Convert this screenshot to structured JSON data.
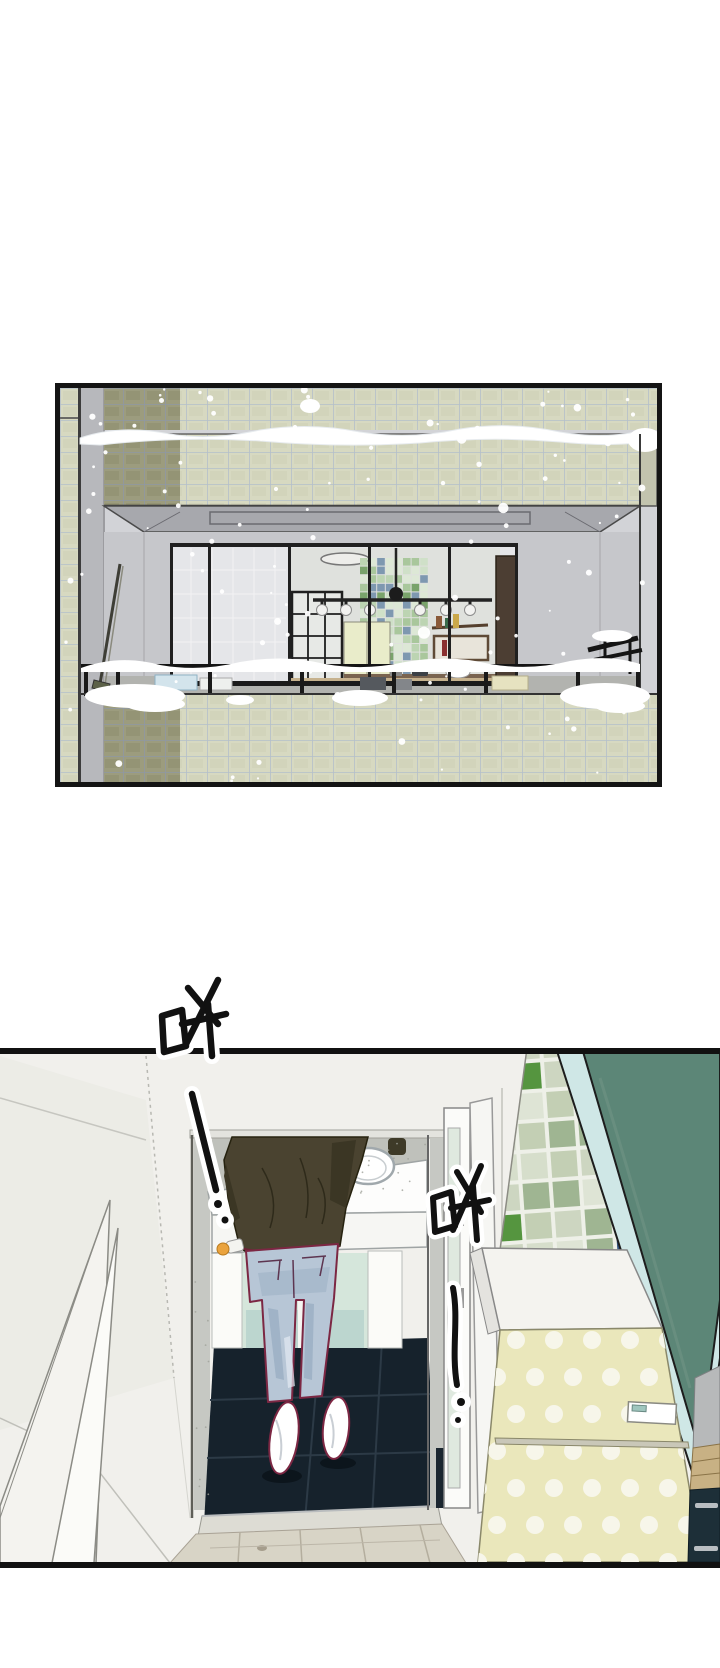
{
  "page": {
    "background_color": "#ffffff",
    "aria_label": "Webtoon comic page segment with two panels",
    "panels": [
      {
        "name": "balcony-exterior-panel",
        "aria_label": "Snow falling past a green-tiled apartment balcony; a lit kitchen with pendant lamps and green mosaic backsplash is visible through the glass wall; snow piles on the railing and ledges"
      },
      {
        "name": "interior-sink-panel",
        "aria_label": "High-angle interior view: a person in a dark olive jacket and light blue jeans stands at a white counter sink in a doorway with dark navy tile floor; green mosaic tiles, a teal glass partition and a yellow polka-dot refrigerator on the right"
      }
    ]
  },
  "sfx": [
    {
      "text": "哗!",
      "style": "hand-brushed, black with white halo",
      "position": "top-left, crossing panel border"
    },
    {
      "text": "哗!",
      "style": "hand-brushed, black with white halo",
      "position": "center-right"
    }
  ],
  "colors": {
    "panel_border": "#141414",
    "snow": "#ffffff",
    "tile_sage": "#d7d9c1",
    "tile_sage_dark": "#9c9c7e",
    "tile_grout": "#b4bfca",
    "facade_gray": "#d2d3d7",
    "balcony_wall": "#c6c7cb",
    "glass": "#e5e6e9",
    "window_frame": "#202020",
    "mosaic_base": "#cfe0c8",
    "mosaic_green": "#79a36b",
    "mosaic_blue": "#7e98b0",
    "cabinet_cream": "#e9ecca",
    "inner_door_brown": "#4c3e33",
    "wall_white": "#f1f0ec",
    "doorframe_gray": "#c6c8c3",
    "counter_white": "#fdfdfc",
    "jacket_olive": "#4a4330",
    "jeans_blue": "#b7c6d6",
    "outline_maroon": "#7c2743",
    "shoe_white": "#ffffff",
    "bath_floor_navy": "#16222c",
    "mint_glass": "#d5e6db",
    "teal_panel": "#5c8677",
    "teal_edge": "#cfe7e6",
    "p2_tile_accent_green": "#55953f",
    "p2_tile_accent_blue": "#33537e",
    "fridge_yellow": "#eae7bb",
    "fridge_dot": "#f7f6ea",
    "wood_floor": "#d8d4c6",
    "wood_shelf": "#c8b184",
    "drawer_navy": "#1d2f38",
    "sfx_ink": "#111111",
    "sfx_halo": "#ffffff"
  }
}
